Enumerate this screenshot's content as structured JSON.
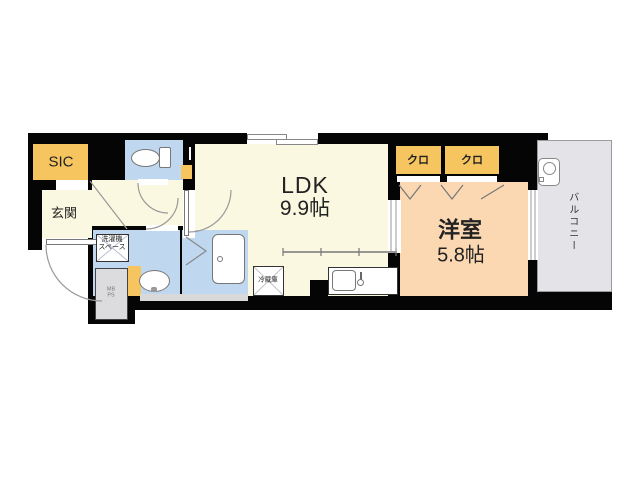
{
  "rooms": {
    "sic": {
      "label": "SIC"
    },
    "genkan": {
      "label": "玄関"
    },
    "ldk": {
      "name": "LDK",
      "size": "9.9帖"
    },
    "western_room": {
      "name": "洋室",
      "size": "5.8帖"
    },
    "closet1": {
      "label": "クロ"
    },
    "closet2": {
      "label": "クロ"
    },
    "balcony": {
      "label": "バルコニー"
    }
  },
  "fixtures": {
    "washer_space": {
      "line1": "洗濯機",
      "line2": "スペース"
    },
    "refrigerator": {
      "label": "冷蔵庫"
    },
    "meter_box": {
      "line1": "MB",
      "line2": "PS"
    }
  },
  "icons": [
    "toilet-icon",
    "bathtub-icon",
    "washbasin-icon",
    "kitchen-sink-icon",
    "water-heater-icon",
    "door-swing-arc",
    "folding-door-marks",
    "sliding-window"
  ],
  "colors": {
    "wall": "#050505",
    "floor_pale_yellow": "#fbf8e1",
    "floor_light_blue": "#bfd7ef",
    "floor_peach": "#fbd8b2",
    "closet_yellow": "#f6c55f",
    "balcony_gray": "#e4e4e8",
    "utility_gray": "#dcdcdf"
  }
}
